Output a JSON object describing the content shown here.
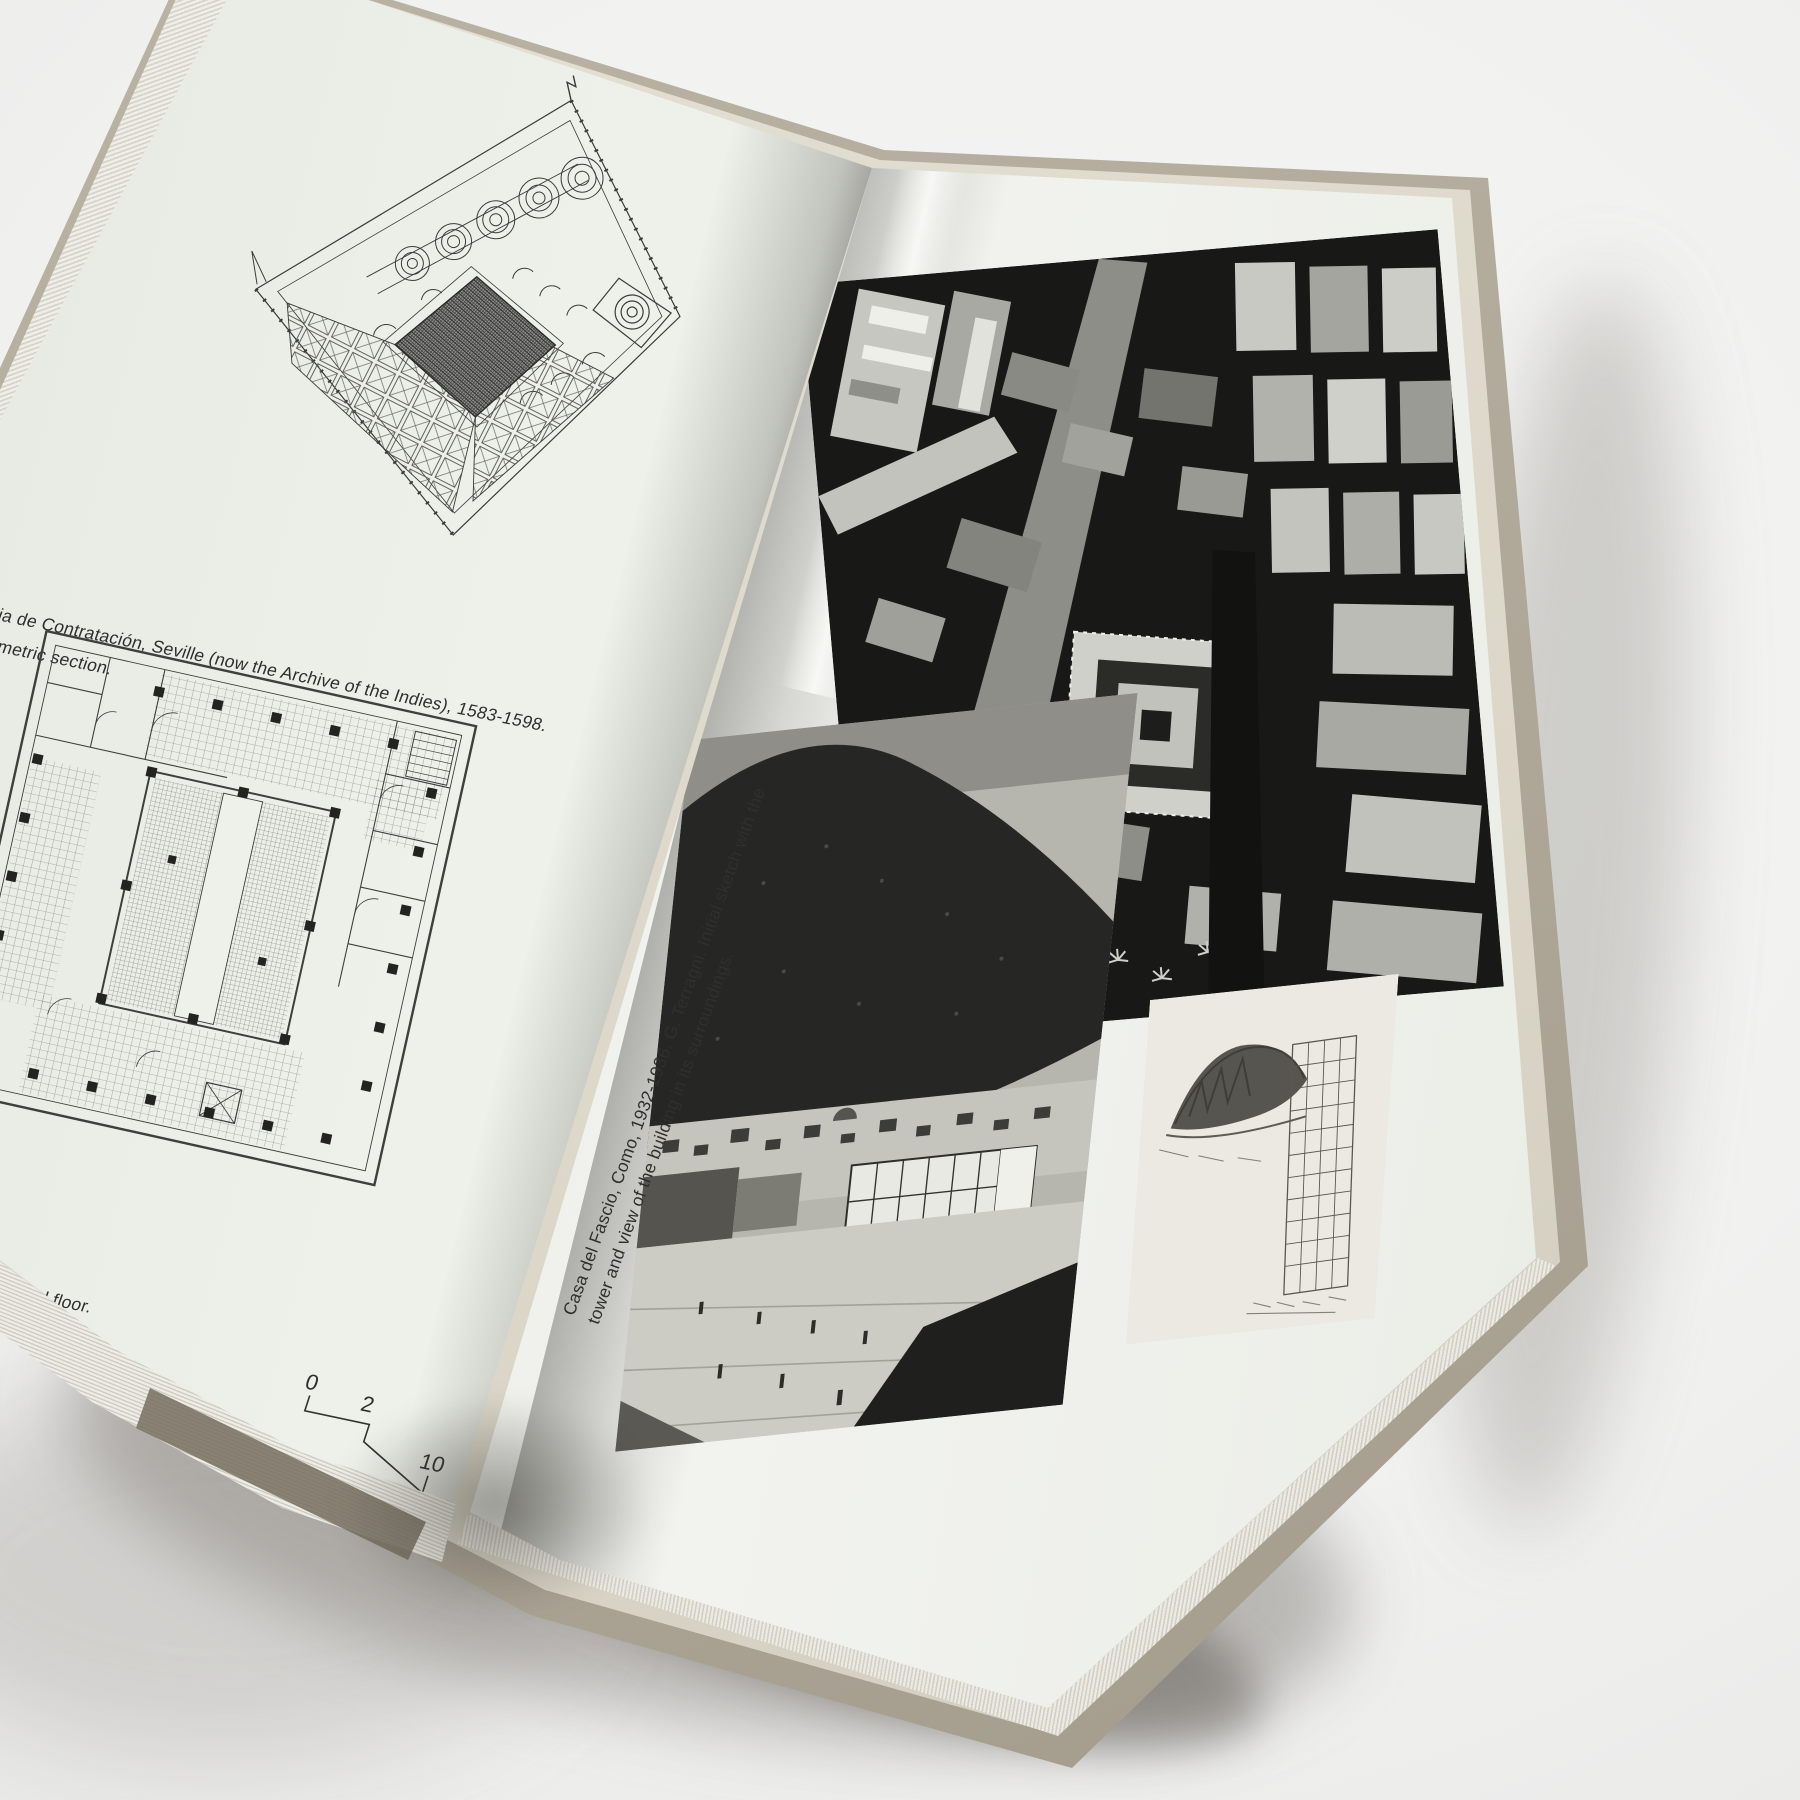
{
  "scene": {
    "subject": "open-architecture-book-spread-photo"
  },
  "colors": {
    "backdrop": "#f2f2f1",
    "paper": "#edefe9",
    "paper_gutter": "#d7d9d2",
    "page_edge_cream": "#ded9cb",
    "cover_board": "#b2ab9c",
    "ink": "#2f2f2d",
    "photo_black": "#161615"
  },
  "left_page": {
    "figure_top": {
      "name": "axonometric-cutaway-drawing"
    },
    "caption_top_line1": "nja de Contratación, Seville (now the Archive of the Indies), 1583-1598.",
    "caption_top_line2": "nometric section.",
    "figure_bottom": {
      "name": "third-floor-plan-drawing"
    },
    "caption_bottom": "he third floor.",
    "scale_bar": {
      "label_start": "0",
      "label_mid": "2",
      "label_end": "10"
    }
  },
  "right_page": {
    "photo_top": {
      "name": "aerial-photograph-city"
    },
    "photo_left": {
      "name": "casa-del-fascio-photograph"
    },
    "sketch": {
      "name": "tower-grid-sketch"
    },
    "caption_line1": "Casa del Fascio, Como, 1932-1936. G. Terragni. Initial sketch with the",
    "caption_line2": "tower and view of the building in its surroundings."
  }
}
